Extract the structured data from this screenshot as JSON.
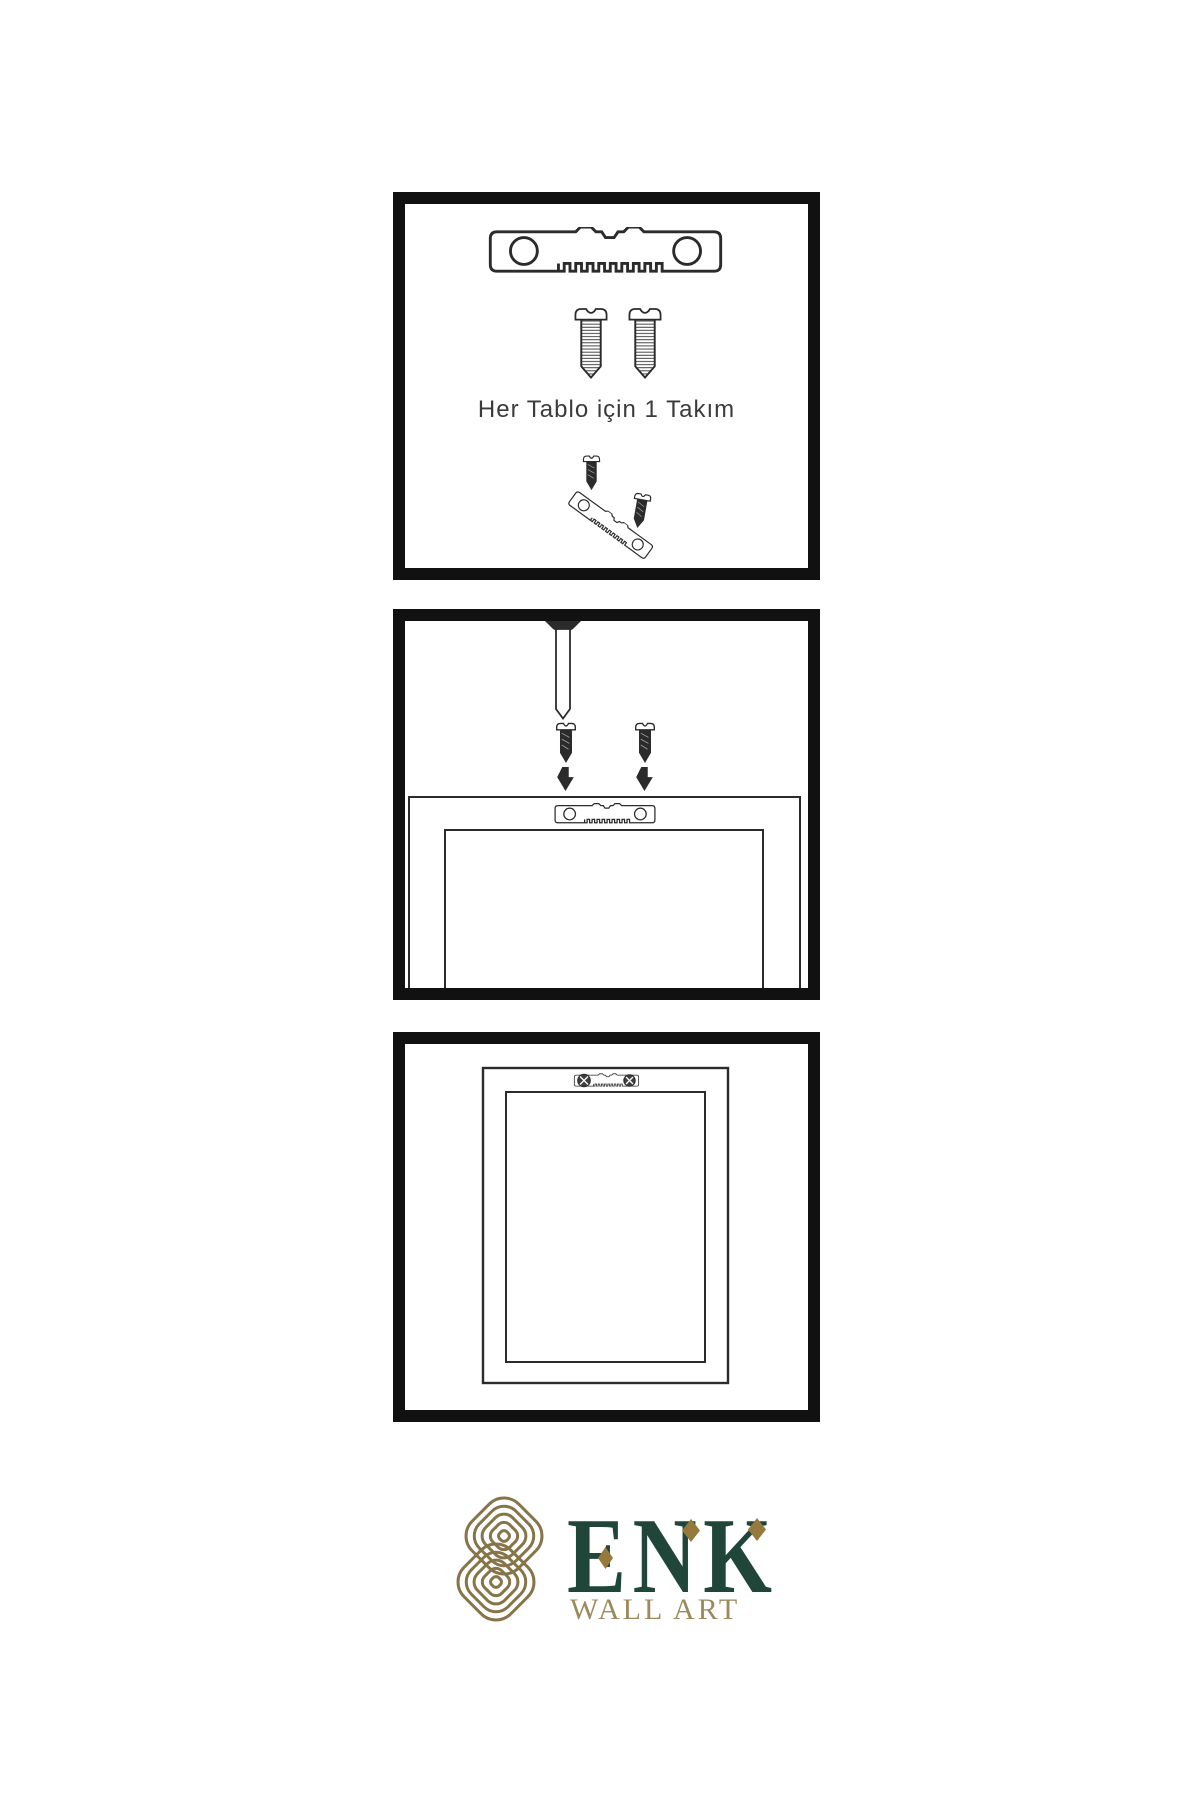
{
  "colors": {
    "background": "#ffffff",
    "ink": "#2b2b2b",
    "panel_border": "#111111",
    "brand_green": "#20463a",
    "brand_gold": "#96793c",
    "knot_gold": "#877549",
    "tagline_gold": "#9c8a5e"
  },
  "panels": [
    {
      "name": "kit-contents",
      "label": "Her Tablo için 1 Takım",
      "icons": [
        "sawtooth-hanger-icon",
        "mounting-screw-icon",
        "mounting-screw-icon",
        "hanger-assembly-icon"
      ]
    },
    {
      "name": "mounting-step",
      "icons": [
        "wall-nail-icon",
        "screw-icon",
        "screw-icon",
        "arrow-down-icon",
        "arrow-down-icon",
        "sawtooth-hanger-on-frame-icon",
        "frame-back-icon"
      ]
    },
    {
      "name": "hung-frame-step",
      "icons": [
        "installed-sawtooth-hanger-icon",
        "picture-frame-icon"
      ]
    }
  ],
  "logo": {
    "brand": "ENK",
    "tagline": "WALL ART",
    "icon": "knot-icon"
  }
}
